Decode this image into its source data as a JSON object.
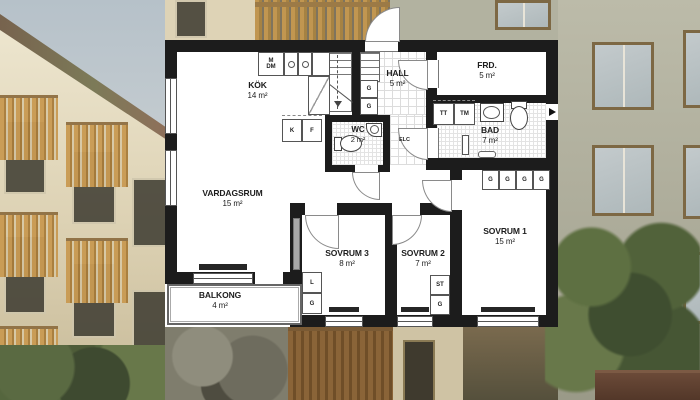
{
  "floorplan": {
    "rooms": [
      {
        "name": "KÖK",
        "area": "14 m²"
      },
      {
        "name": "VARDAGSRUM",
        "area": "15 m²"
      },
      {
        "name": "HALL",
        "area": "5 m²"
      },
      {
        "name": "FRD.",
        "area": "5 m²"
      },
      {
        "name": "WC",
        "area": "2 m²"
      },
      {
        "name": "BAD",
        "area": "7 m²"
      },
      {
        "name": "SOVRUM 1",
        "area": "15 m²"
      },
      {
        "name": "SOVRUM 2",
        "area": "7 m²"
      },
      {
        "name": "SOVRUM 3",
        "area": "8 m²"
      },
      {
        "name": "BALKONG",
        "area": "4 m²"
      }
    ],
    "fixtures": {
      "microwave": "M",
      "dishwasher": "DM",
      "fridge": "K",
      "freezer": "F",
      "wardrobe": "G",
      "linen": "L",
      "cleaning": "ST",
      "dryer": "TT",
      "washer": "TM",
      "electrical": "ELC"
    },
    "colors": {
      "wall": "#1c1c1c",
      "floor": "#ffffff",
      "tile_line": "#dcdcdc",
      "balcony_wood": "#c99a52",
      "facade_left": "#ddd2b4",
      "facade_right": "#b2b2a0",
      "sky": "#c4cdd2",
      "foliage": "#4c5a38"
    }
  }
}
